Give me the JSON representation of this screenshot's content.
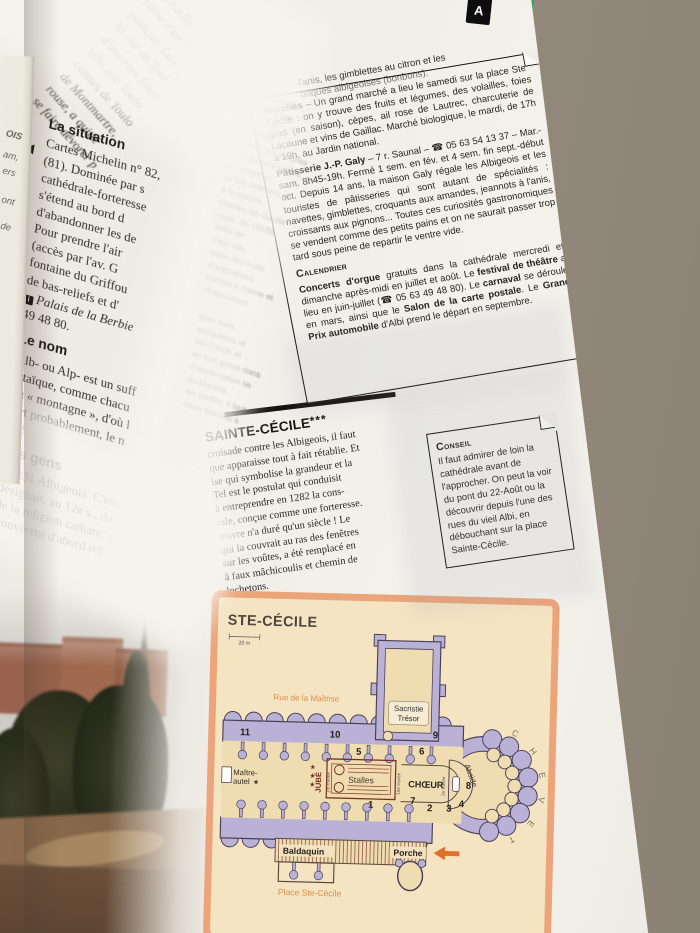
{
  "colors": {
    "book_edge_green": "#2ca85d",
    "plan_frame": "#eca47a",
    "plan_wall": "#b9b2d6",
    "plan_parchment": "#f4e4c2",
    "plan_accent_orange": "#d98f52",
    "arrow_orange": "#e2702b",
    "stalls_red": "#7a2f20",
    "tab_black": "#0d0d0d"
  },
  "book": {
    "tab_letter": "A"
  },
  "edge_fragments": [
    "OIS",
    "am,",
    "ers",
    "ont",
    "de"
  ],
  "intro": {
    "lines": [
      "ses ruelle",
      "l'âme d'un",
      "pudique. La c",
      "la cité de Toul",
      "d'une rare fines",
      "ville que Toulo",
      "comtes de Toulo",
      "de Montmartre,",
      "rouse, a quitté",
      "se faire dévorer p"
    ]
  },
  "left_column": {
    "marker": "◀",
    "situation": {
      "heading": "La situation",
      "lines": [
        "Cartes Michelin n° 82,",
        "(81). Dominée par s",
        "cathédrale-forteresse",
        "s'étend au bord d",
        "d'abandonner les de",
        "Pour prendre l'air",
        "(accès par l'av. G",
        "fontaine du Griffou",
        "de bas-reliefs et d'"
      ],
      "badge": "i",
      "palais": "Palais de la Berbie",
      "phone": "49 48 80."
    },
    "nom": {
      "heading": "Le nom",
      "lines": [
        "Alb- ou Alp- est un suff",
        "altaïque, comme chacu",
        "ou « montagne », d'où l",
        "fort probablement, le n",
        "ça !"
      ]
    },
    "gens": {
      "heading": "Les gens",
      "lines": [
        "66 231 Albigeois. C'est",
        "désignait, au 12e s., da",
        "de la religion cathare, s",
        "trouvèrent d'abord ref"
      ]
    }
  },
  "mid_column": {
    "group1": [
      "-sam. 23h30-5h.",
      "à la mode, non",
      "à Castres et",
      "Tout salles",
      "des volumes sonores",
      "la jungle en passant",
      "un instant au",
      "du bar extérieur et",
      "à la piscine",
      "Charles-de-Gaulle",
      "-sam. 8h-15h30",
      "boîte de",
      "c'est ville",
      "cœur des nuits",
      "d'animations",
      "soirées à thème et",
      "chaleureuse"
    ],
    "group2": [
      "ques rues",
      "antiquaires et",
      "Ste-Cécile et",
      "en tout genre dans",
      "d'alimentation se",
      "du Marché.",
      "les confits, il faut",
      "cieux biscuits à"
    ]
  },
  "pre_box": {
    "lines": [
      "l'anis, les gimblettes au citron et les",
      "briques albigeoises (bonbons)."
    ]
  },
  "address_box": {
    "marches": {
      "label": "Marchés",
      "text": " – Un grand marché a lieu le samedi sur la place Ste-Cécile : on y trouve des fruits et légumes, des volailles, foies gras (en saison), cèpes, ail rose de Lautrec, charcuterie de Lacaune et vins de Gaillac. Marché biologique, le mardi, de 17h à 19h, au Jardin national."
    },
    "patisserie": {
      "label": "Pâtisserie J.-P. Galy",
      "text": " – 7 r. Saunal – ☎ 05 63 54 13 37 – Mar.-sam. 8h45-19h. Fermé 1 sem. en fév. et 4 sem. fin sept.-début oct. Depuis 14 ans, la maison Galy régale les Albigeois et les touristes de pâtisseries qui sont autant de spécialités : navettes, gimblettes, croquants aux amandes, jeannots à l'anis, croissants aux pignons... Toutes ces curiosités gastronomiques se vendent comme des petits pains et on ne saurait passer trop tard sous peine de repartir le ventre vide."
    },
    "calendrier": {
      "heading": "Calendrier",
      "parts": [
        "Concerts d'orgue",
        " gratuits dans la cathédrale mercredi et dimanche après-midi en juillet et août. Le ",
        "festival de théâtre",
        " a lieu en juin-juillet (☎ 05 63 49 48 80). Le ",
        "carnaval",
        " se déroule en mars, ainsi que le ",
        "Salon de la carte postale",
        ". Le ",
        "Grand Prix automobile",
        " d'Albi prend le départ en septembre."
      ]
    }
  },
  "sainte_cecile": {
    "heading": "SAINTE-CÉCILE",
    "stars": "***",
    "lines": [
      "croisade contre les Albigeois, il faut",
      "que apparaisse tout à fait rétablie. Et",
      "ise qui symbolise la grandeur et la",
      "Tel est le postulat qui conduisit",
      "à entreprendre en 1282 la cons-",
      "rale, conçue comme une forteresse.",
      "œuvre n'a duré qu'un siècle ! Le",
      "qui la couvrait au ras des fenêtres",
      "sur les voûtes, a été remplacé en",
      "à faux mâchicoulis et chemin de",
      "lochetons."
    ]
  },
  "conseil": {
    "heading": "Conseil",
    "text": "Il faut admirer de loin la cathédrale avant de l'approcher. On peut la voir du pont du 22-Août ou la découvrir depuis l'une des rues du vieil Albi, en débouchant sur la place Sainte-Cécile."
  },
  "plan": {
    "title": "STE-CÉCILE",
    "scale": "20 m",
    "street": "Rue de la Maîtrise",
    "sacristie1": "Sacristie",
    "sacristie2": "Trésor",
    "maitre1": "Maître-",
    "maitre2": "autel",
    "star": "★",
    "jube": "JUBÉ",
    "stalles": "Stalles",
    "choeur": "CHŒUR",
    "abside": "Abside",
    "baldaquin": "Baldaquin",
    "porche": "Porche",
    "place": "Place Ste-Cécile",
    "travee1": "1re travée",
    "travee2": "2e travée",
    "travee10": "10e travée",
    "numbers": [
      "1",
      "2",
      "3",
      "4",
      "5",
      "6",
      "7",
      "8",
      "9",
      "10",
      "11"
    ],
    "chevet": [
      "C",
      "H",
      "E",
      "V",
      "E",
      "T"
    ]
  }
}
